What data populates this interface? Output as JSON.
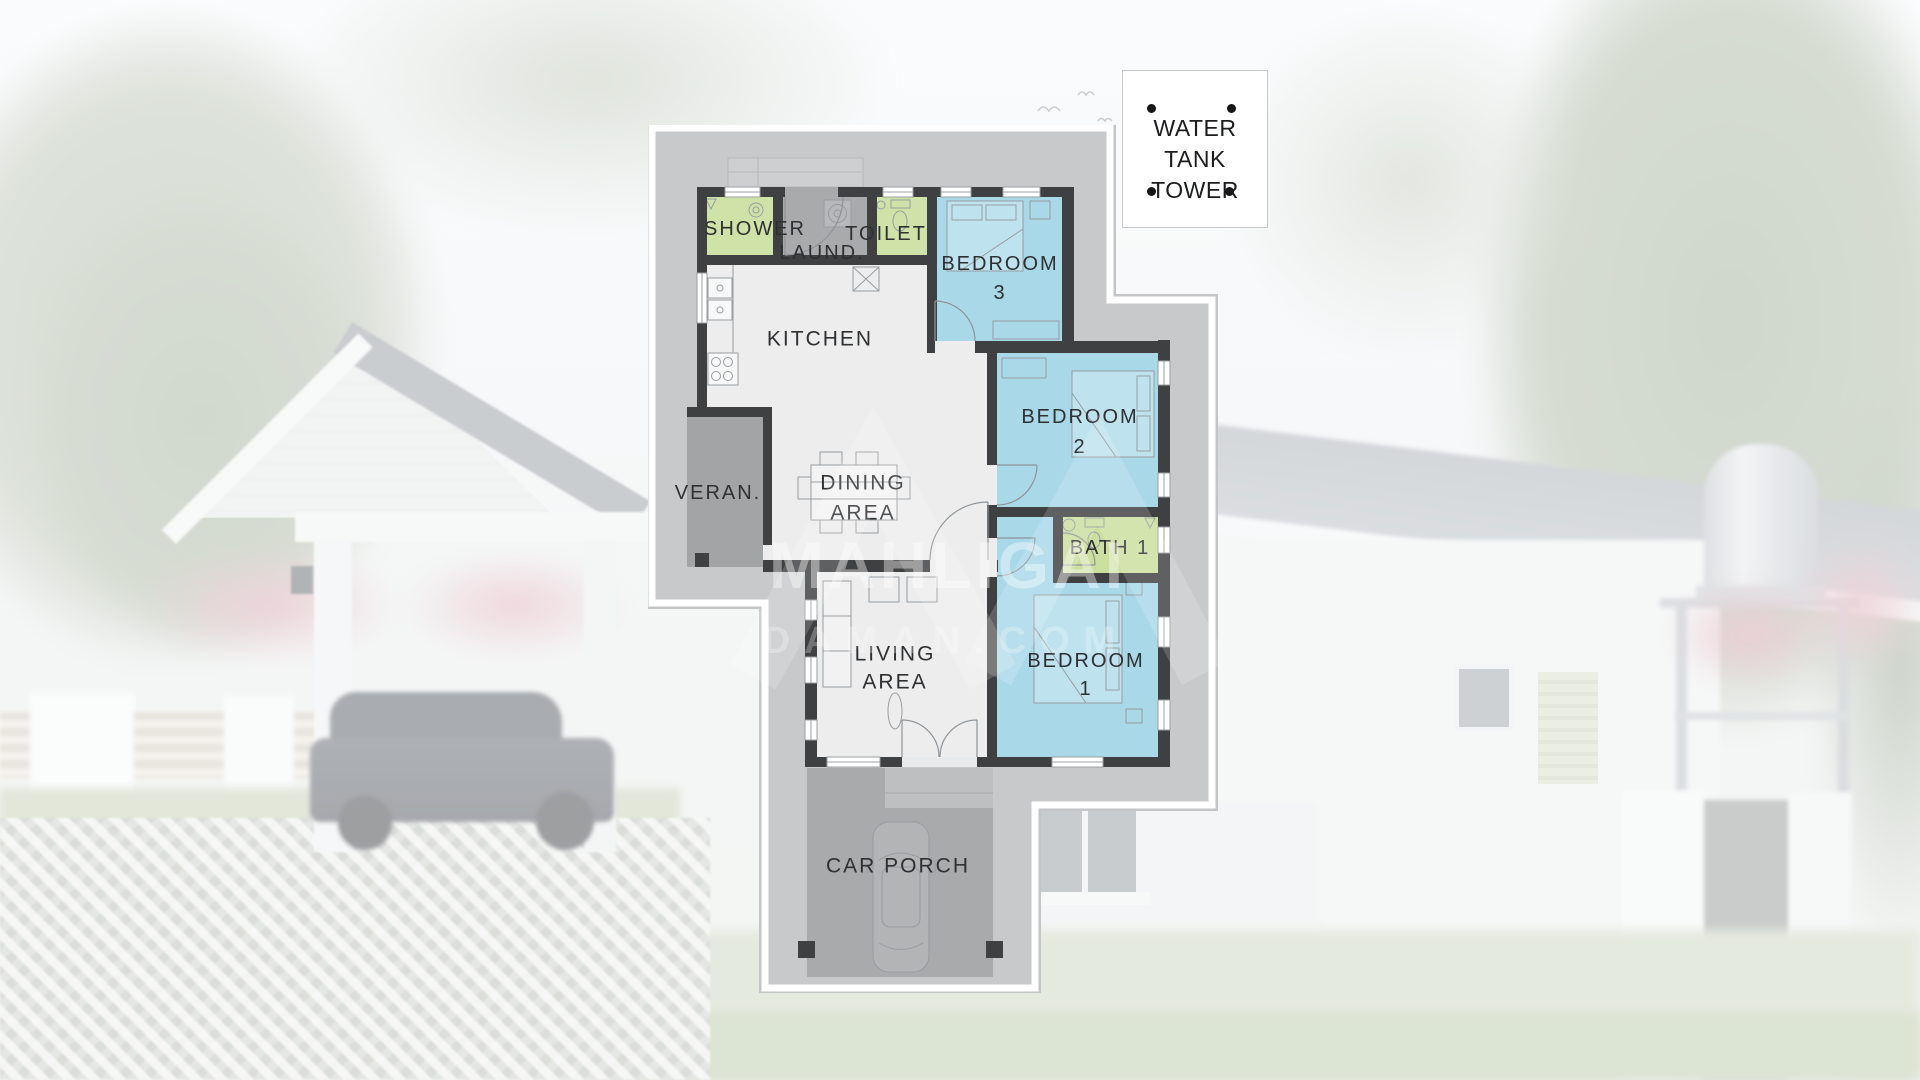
{
  "water_tank_callout": {
    "line1": "WATER TANK",
    "line2": "TOWER"
  },
  "rooms": {
    "shower": "SHOWER",
    "laundry": "LAUND.",
    "toilet": "TOILET",
    "bedroom3": {
      "line1": "BEDROOM",
      "line2": "3"
    },
    "kitchen": "KITCHEN",
    "veranda": "VERAN.",
    "dining": {
      "line1": "DINING",
      "line2": "AREA"
    },
    "bedroom2": {
      "line1": "BEDROOM",
      "line2": "2"
    },
    "bath1": "BATH 1",
    "bedroom1": {
      "line1": "BEDROOM",
      "line2": "1"
    },
    "living": {
      "line1": "LIVING",
      "line2": "AREA"
    },
    "car_porch": "CAR PORCH"
  },
  "watermark": {
    "line1": "MAHLIGAI",
    "line2": "DAMAN.COM"
  },
  "colors": {
    "plan_background": "#c8c9ca",
    "open_floor": "#ededee",
    "bedroom_fill": "#a9d8e9",
    "bath_fill": "#cbdf9e",
    "service_gray": "#a8aaab",
    "wall": "#3f4041",
    "label_text": "#2e3032"
  }
}
